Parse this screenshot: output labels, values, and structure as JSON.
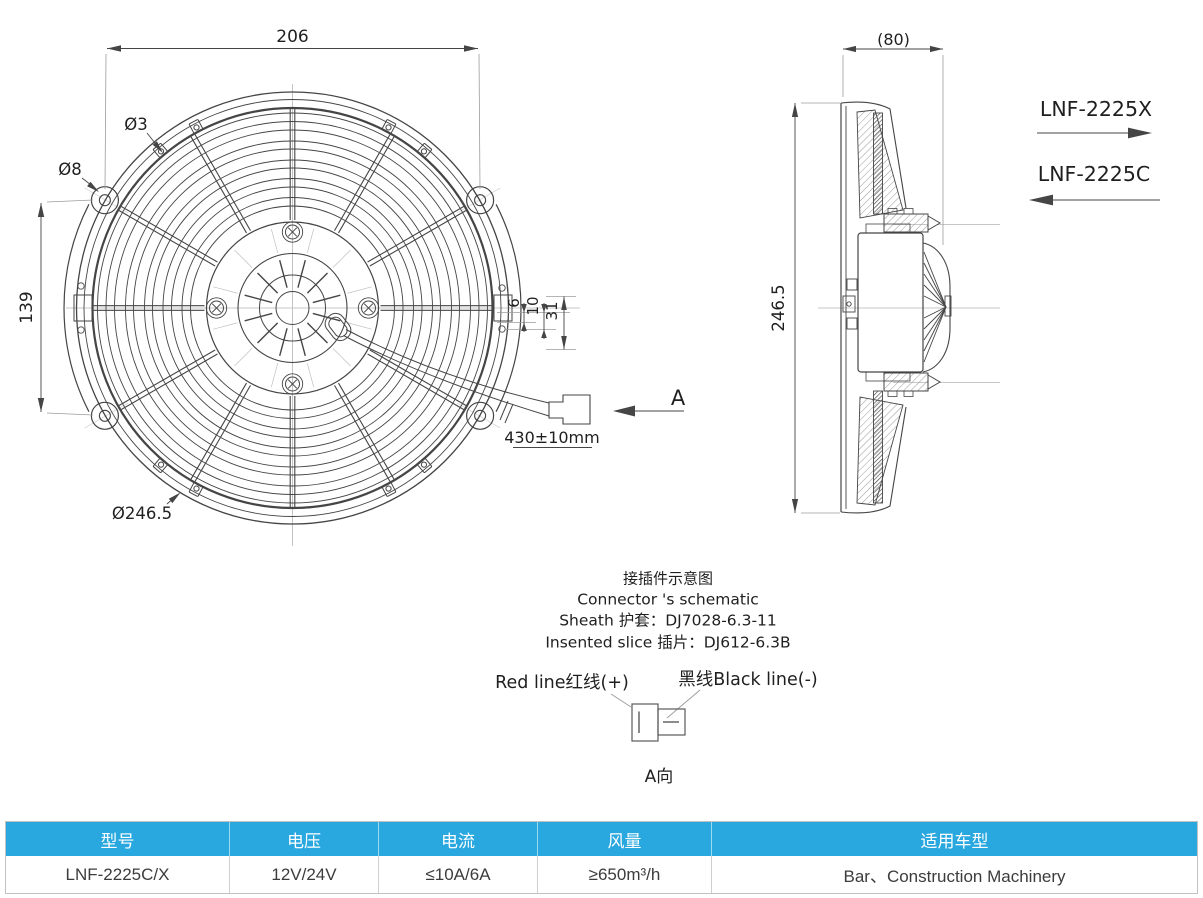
{
  "drawing": {
    "front_view": {
      "width_dim": "206",
      "clip_hole_dim": "Ø3",
      "ear_hole_dim": "Ø8",
      "vertical_dim": "139",
      "outer_diameter_dim": "Ø246.5",
      "tab_dim_6": "6",
      "tab_dim_10": "10",
      "tab_dim_31": "31",
      "wire_length_dim": "430±10mm",
      "view_arrow": "A"
    },
    "side_view": {
      "depth_dim": "(80)",
      "height_dim": "246.5"
    },
    "models": {
      "model_push": "LNF-2225X",
      "model_pull": "LNF-2225C"
    },
    "connector_note": {
      "title_zh": "接插件示意图",
      "title_en": "Connector 's schematic",
      "sheath": "Sheath 护套：DJ7028-6.3-11",
      "insert": "Insented slice 插片：DJ612-6.3B",
      "red_wire": "Red line红线(+)",
      "black_wire": "黑线Black line(-)",
      "view_label": "A向"
    }
  },
  "table": {
    "headers": [
      "型号",
      "电压",
      "电流",
      "风量",
      "适用车型"
    ],
    "rows": [
      [
        "LNF-2225C/X",
        "12V/24V",
        "≤10A/6A",
        "≥650m³/h",
        "Bar、Construction Machinery"
      ]
    ]
  },
  "colors": {
    "table_header_bg": "#29a8e0",
    "table_header_text": "#ffffff",
    "line_color": "#454545",
    "centerline_color": "#b5b5b5"
  }
}
